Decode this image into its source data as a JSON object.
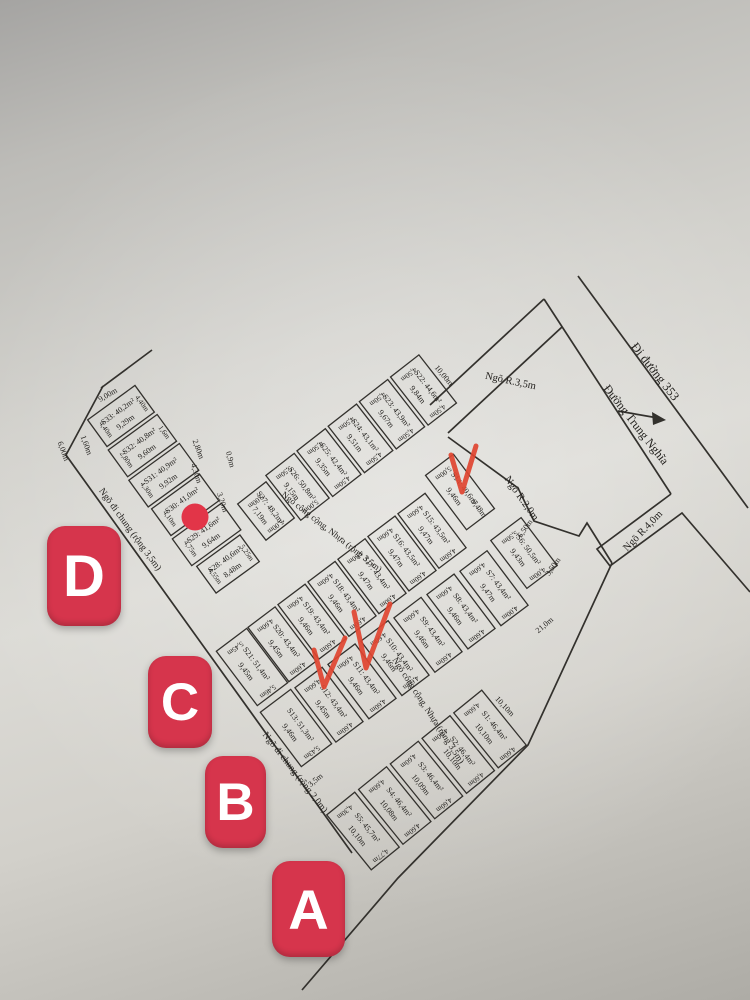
{
  "badges": [
    {
      "letter": "D",
      "x": 47,
      "y": 526,
      "w": 74,
      "h": 100
    },
    {
      "letter": "C",
      "x": 148,
      "y": 656,
      "w": 64,
      "h": 92
    },
    {
      "letter": "B",
      "x": 205,
      "y": 756,
      "w": 61,
      "h": 92
    },
    {
      "letter": "A",
      "x": 272,
      "y": 861,
      "w": 73,
      "h": 96
    }
  ],
  "colors": {
    "badge": "#d6354c",
    "checkmark": "#e04430",
    "dot": "#e23548",
    "map_line": "#33312d",
    "map_text": "#23211e"
  },
  "map": {
    "streets": [
      {
        "text": "Đi đường 353",
        "x": 652,
        "y": 374,
        "rot": 52,
        "size": 12.5
      },
      {
        "text": "Đường Trung Nghĩa",
        "x": 633,
        "y": 427,
        "rot": 52,
        "size": 12
      },
      {
        "text": "Ngõ R.3,5m",
        "x": 510,
        "y": 384,
        "rot": 12,
        "size": 10.5
      },
      {
        "text": "Ngõ R.2,0m",
        "x": 519,
        "y": 500,
        "rot": 55,
        "size": 10.5
      },
      {
        "text": "Ngõ R.4,0m",
        "x": 645,
        "y": 533,
        "rot": -46,
        "size": 10.5
      },
      {
        "text": "Ngõ công cộng, Nhựa (rộng 3,5m)",
        "x": 330,
        "y": 534,
        "rot": 38,
        "size": 9
      },
      {
        "text": "Ngõ công cộng, Nhựa (rộng 3,5m)",
        "x": 426,
        "y": 712,
        "rot": 57,
        "size": 9
      },
      {
        "text": "Ngõ đi chung (rộng 3,5m)",
        "x": 128,
        "y": 531,
        "rot": 54,
        "size": 9.5
      },
      {
        "text": "Ngõ đi chung (rộng 2,0m)",
        "x": 293,
        "y": 774,
        "rot": 52,
        "size": 9.5
      }
    ],
    "dims": [
      {
        "t": "10,00m",
        "x": 442,
        "y": 377,
        "rot": 50
      },
      {
        "t": "0,9m",
        "x": 228,
        "y": 460,
        "rot": 75
      },
      {
        "t": "3,20m",
        "x": 220,
        "y": 503,
        "rot": 72
      },
      {
        "t": "9,48m",
        "x": 477,
        "y": 510,
        "rot": 53
      },
      {
        "t": "6,50m",
        "x": 527,
        "y": 530,
        "rot": -55
      },
      {
        "t": "3,50m",
        "x": 555,
        "y": 568,
        "rot": -55
      },
      {
        "t": "21,0m",
        "x": 546,
        "y": 627,
        "rot": -40
      },
      {
        "t": "3,5m",
        "x": 317,
        "y": 782,
        "rot": -40
      },
      {
        "t": "10,10m",
        "x": 503,
        "y": 708,
        "rot": 47
      },
      {
        "t": "9,00m",
        "x": 109,
        "y": 397,
        "rot": -30
      },
      {
        "t": "1,60m",
        "x": 84,
        "y": 446,
        "rot": 70
      },
      {
        "t": "6,00m",
        "x": 61,
        "y": 452,
        "rot": 70
      },
      {
        "t": "2,80m",
        "x": 196,
        "y": 450,
        "rot": 70
      },
      {
        "t": "4,30m",
        "x": 194,
        "y": 474,
        "rot": 72
      }
    ],
    "strips": {
      "top": [
        {
          "id": "S27",
          "label": "S27: 48,2m²",
          "length": "7,19m",
          "widths": [
            "5,00m",
            "5,00m"
          ]
        },
        {
          "id": "S26",
          "label": "S26: 50,8m²",
          "length": "9,15m",
          "widths": [
            "5,50m",
            "5,00m"
          ]
        },
        {
          "id": "S25",
          "label": "S25: 42,4m²",
          "length": "9,35m",
          "widths": [
            "4,50m",
            "4,50m"
          ]
        },
        {
          "id": "S24",
          "label": "S24: 43,1m²",
          "length": "9,51m",
          "widths": [
            "4,50m",
            "4,50m"
          ]
        },
        {
          "id": "S23",
          "label": "S23: 43,9m²",
          "length": "9,67m",
          "widths": [
            "4,50m",
            "4,50m"
          ]
        },
        {
          "id": "S22",
          "label": "S22: 44,6m²",
          "length": "9,84m",
          "widths": [
            "4,50m",
            "4,50m"
          ]
        }
      ],
      "middle_nw": [
        {
          "id": "S21",
          "label": "S21: 51,4m²",
          "length": "9,45m",
          "widths": [
            "5,45m",
            "5,46m"
          ]
        },
        {
          "id": "S20",
          "label": "S20: 43,4m²",
          "length": "9,45m",
          "widths": [
            "4,60m",
            "4,60m"
          ]
        },
        {
          "id": "S19",
          "label": "S19: 43,4m²",
          "length": "9,46m",
          "widths": [
            "4,60m",
            "4,60m"
          ]
        },
        {
          "id": "S18",
          "label": "S18: 43,4m²",
          "length": "9,46m",
          "widths": [
            "4,60m",
            "4,60m"
          ]
        },
        {
          "id": "S17",
          "label": "S17: 43,4m²",
          "length": "9,47m",
          "widths": [
            "4,60m",
            "4,60m"
          ]
        },
        {
          "id": "S16",
          "label": "S16: 43,5m²",
          "length": "9,47m",
          "widths": [
            "4,60m",
            "4,60m"
          ]
        },
        {
          "id": "S15",
          "label": "S15: 43,5m²",
          "length": "9,47m",
          "widths": [
            "4,60m",
            "4,60m"
          ]
        },
        {
          "id": "S14",
          "label": "S14: 49,6m²",
          "length": "9,46m",
          "widths": [
            "5,00m"
          ],
          "check": true
        }
      ],
      "middle_se": [
        {
          "id": "S13",
          "label": "S13: 51,3m²",
          "length": "9,46m",
          "widths": [
            null,
            "5,43m"
          ]
        },
        {
          "id": "S12",
          "label": "S12: 43,4m²",
          "length": "9,45m",
          "widths": [
            "4,60m",
            "4,60m"
          ],
          "check": true
        },
        {
          "id": "S11",
          "label": "S11: 43,4m²",
          "length": "9,46m",
          "widths": [
            "4,60m",
            "4,60m"
          ],
          "check": true
        },
        {
          "id": "S10",
          "label": "S10: 43,4m²",
          "length": "9,46m",
          "widths": [
            "4,60m",
            "4,60m"
          ]
        },
        {
          "id": "S9",
          "label": "S9: 43,4m²",
          "length": "9,46m",
          "widths": [
            "4,60m",
            "4,60m"
          ]
        },
        {
          "id": "S8",
          "label": "S8: 43,4m²",
          "length": "9,46m",
          "widths": [
            "4,60m",
            "4,60m"
          ]
        },
        {
          "id": "S7",
          "label": "S7: 43,4m²",
          "length": "9,47m",
          "widths": [
            "4,60m",
            "4,00m"
          ]
        },
        {
          "id": "S6",
          "label": "S6: 50,5m²",
          "length": "9,43m",
          "widths": [
            "5,50m",
            "4,00m"
          ]
        }
      ],
      "bottom": [
        {
          "id": "S5",
          "label": "S5: 45,7m²",
          "length": "10,10m",
          "widths": [
            "4,30m",
            "4,77m"
          ]
        },
        {
          "id": "S4",
          "label": "S4: 46,4m²",
          "length": "10,08m",
          "widths": [
            "4,60m",
            "4,60m"
          ]
        },
        {
          "id": "S3",
          "label": "S3: 46,4m²",
          "length": "10,09m",
          "widths": [
            "4,60m",
            "4,60m"
          ]
        },
        {
          "id": "S2",
          "label": "S2: 46,4m²",
          "length": "10,10m",
          "widths": [
            "4,60m",
            "4,60m"
          ]
        },
        {
          "id": "S1",
          "label": "S1: 46,4m²",
          "length": "10,10m",
          "widths": [
            "4,60m",
            "4,60m"
          ]
        }
      ],
      "left": [
        {
          "id": "S28",
          "label": "S28: 40,6m²",
          "length": "8,48m",
          "widths": [
            "4,55m",
            "5,25m"
          ]
        },
        {
          "id": "S29",
          "label": "S29: 41,6m²",
          "length": "9,64m",
          "widths": [
            "4,75m"
          ]
        },
        {
          "id": "S30",
          "label": "S30: 41,0m²",
          "length": "",
          "widths": [
            "4,10m"
          ]
        },
        {
          "id": "S31",
          "label": "S31: 40,9m²",
          "length": "9,92m",
          "widths": [
            "4,30m"
          ]
        },
        {
          "id": "S32",
          "label": "S32: 40,8m²",
          "length": "9,60m",
          "widths": [
            "2,80m",
            "1,6m"
          ]
        },
        {
          "id": "S33",
          "label": "S33: 40,2m²",
          "length": "9,29m",
          "widths": [
            "4,40m",
            "4,40m"
          ]
        }
      ]
    },
    "annotations": {
      "checks": [
        "S14",
        "S11",
        "S12"
      ],
      "dot": {
        "x": 195,
        "y": 517
      }
    }
  }
}
